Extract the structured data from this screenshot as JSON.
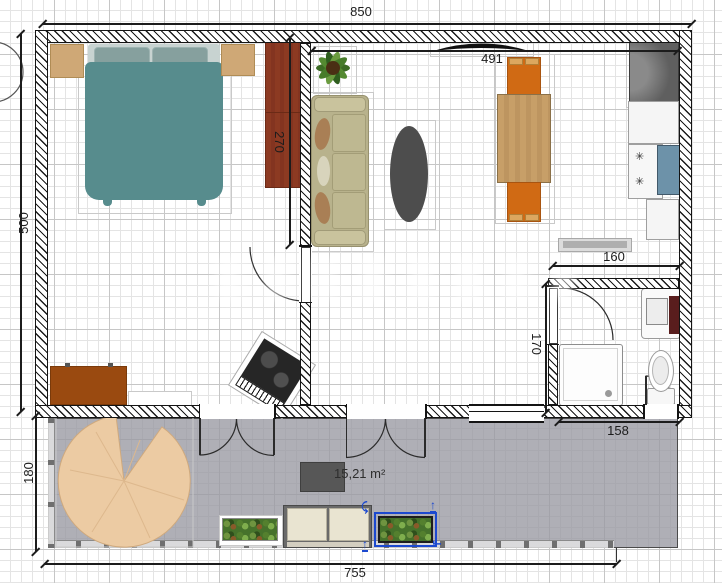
{
  "app": "floor-plan-editor",
  "dimensions": {
    "top_width": "850",
    "left_height": "500",
    "living_room_width": "491",
    "bedroom_partition": "270",
    "kitchen_passage": "160",
    "hall_height": "170",
    "bathroom_width": "158",
    "terrace_depth": "180",
    "terrace_width": "755"
  },
  "labels": {
    "terrace_area": "15,21 m²"
  },
  "colors": {
    "selection_blue": "#1c49cf",
    "wall_line": "#141414",
    "terrace_floor": "#9e9ea6",
    "rug": "#eccba3",
    "bed": "#578c8d",
    "wardrobe": "#8c3a22",
    "sofa": "#b8b28c",
    "dining_chair": "#d06a14",
    "dining_table": "#c79f68",
    "coffee_table": "#4d4d4d",
    "fridge": "#5f5f5f",
    "kitchen_sink": "#6d92a9",
    "vanity_accent": "#591d1d",
    "desk": "#9a4a10"
  },
  "furniture": [
    {
      "name": "double-bed"
    },
    {
      "name": "nightstand-left"
    },
    {
      "name": "nightstand-right"
    },
    {
      "name": "wardrobe"
    },
    {
      "name": "desk"
    },
    {
      "name": "desk-chair"
    },
    {
      "name": "piano"
    },
    {
      "name": "sofa"
    },
    {
      "name": "coffee-table"
    },
    {
      "name": "potted-plant"
    },
    {
      "name": "wall-tv"
    },
    {
      "name": "dining-table"
    },
    {
      "name": "dining-chair-top"
    },
    {
      "name": "dining-chair-bottom"
    },
    {
      "name": "fridge"
    },
    {
      "name": "kitchen-counter"
    },
    {
      "name": "cooktop"
    },
    {
      "name": "kitchen-sink"
    },
    {
      "name": "sideboard"
    },
    {
      "name": "shower"
    },
    {
      "name": "toilet"
    },
    {
      "name": "bathroom-vanity"
    },
    {
      "name": "round-rug"
    },
    {
      "name": "grill-table"
    },
    {
      "name": "planter-left"
    },
    {
      "name": "terrace-bench"
    },
    {
      "name": "planter-selected"
    }
  ]
}
